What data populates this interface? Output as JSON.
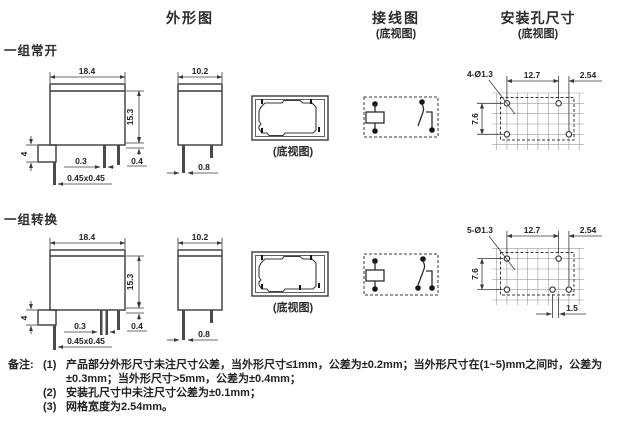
{
  "headers": {
    "outline": "外形图",
    "wiring": "接线图",
    "wiring_sub": "(底视图)",
    "mounting": "安装孔尺寸",
    "mounting_sub": "(底视图)"
  },
  "rows": [
    {
      "label": "一组常开",
      "outline": {
        "front_width": "18.4",
        "front_height": "15.3",
        "tab_height": "4",
        "pin_mid": "0.3",
        "pin_square": "0.45x0.45",
        "standoff": "0.4",
        "side_width": "10.2",
        "side_pin": "0.8"
      },
      "bottom_caption": "(底视图)",
      "mounting": {
        "holes": "4-Ø1.3",
        "pitch_h": "12.7",
        "grid": "2.54",
        "pitch_v": "7.6"
      }
    },
    {
      "label": "一组转换",
      "outline": {
        "front_width": "18.4",
        "front_height": "15.3",
        "tab_height": "4",
        "pin_mid": "0.3",
        "pin_square": "0.45x0.45",
        "standoff": "0.4",
        "side_width": "10.2",
        "side_pin": "0.8"
      },
      "bottom_caption": "(底视图)",
      "mounting": {
        "holes": "5-Ø1.3",
        "pitch_h": "12.7",
        "grid": "2.54",
        "pitch_v": "7.6",
        "offset": "1.5"
      }
    }
  ],
  "notes": {
    "label": "备注:",
    "items": [
      {
        "num": "(1)",
        "text": "产品部分外形尺寸未注尺寸公差，当外形尺寸≤1mm，公差为±0.2mm；当外形尺寸在(1~5)mm之间时，公差为±0.3mm；当外形尺寸>5mm，公差为±0.4mm；"
      },
      {
        "num": "(2)",
        "text": "安装孔尺寸中未注尺寸公差为±0.1mm；"
      },
      {
        "num": "(3)",
        "text": "网格宽度为2.54mm。"
      }
    ]
  }
}
